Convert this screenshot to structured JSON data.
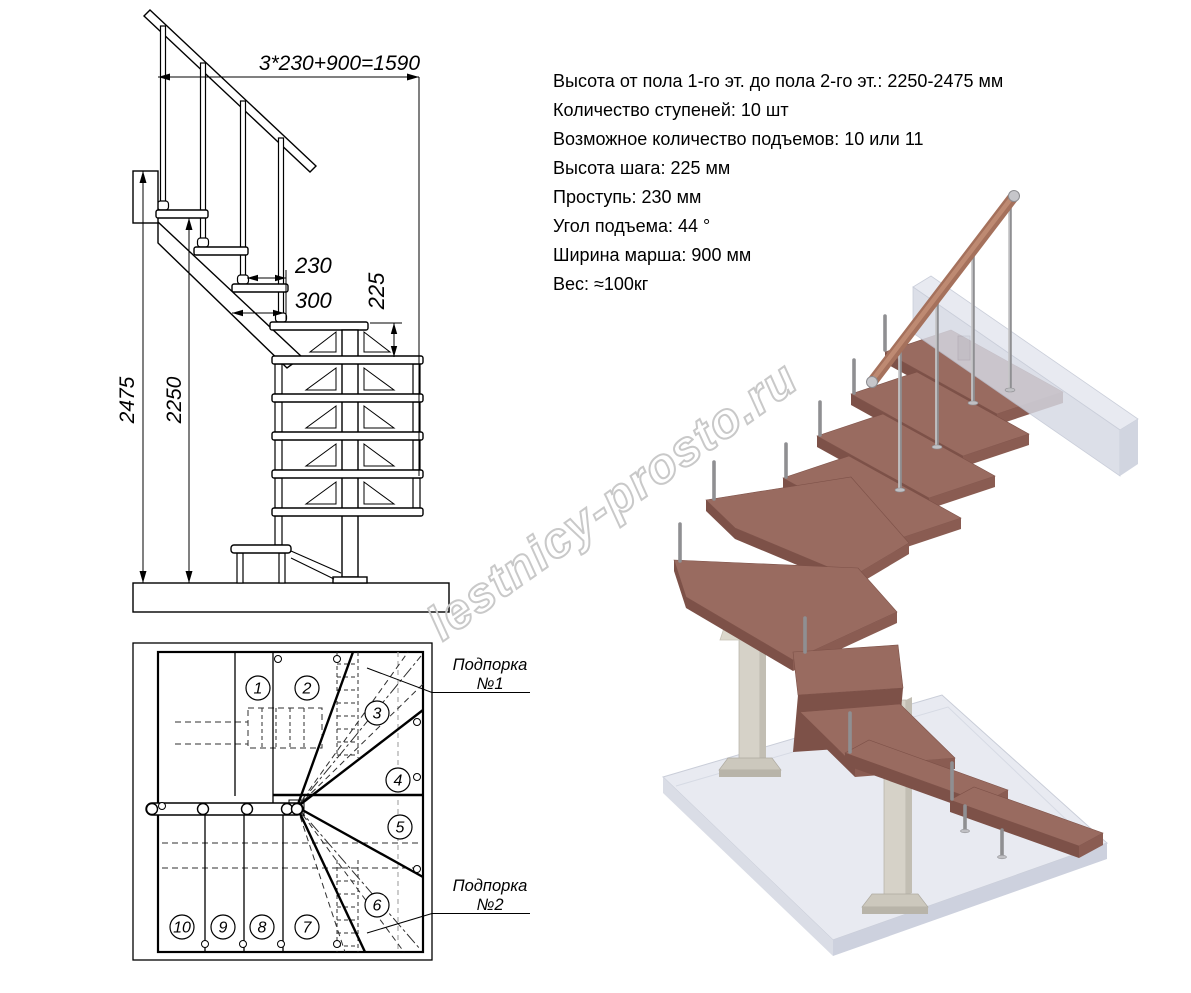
{
  "specs": {
    "lines": [
      "Высота от пола 1-го эт. до пола 2-го эт.: 2250-2475 мм",
      "Количество ступеней: 10 шт",
      "Возможное количество подъемов: 10 или 11",
      "Высота шага: 225 мм",
      "Проступь: 230 мм",
      "Угол подъема: 44 °",
      "Ширина марша: 900 мм",
      "Вес: ≈100кг"
    ]
  },
  "elevation": {
    "dim_total": "3*230+900=1590",
    "dim_run": "230",
    "dim_overlap": "300",
    "dim_rise": "225",
    "dim_height_max": "2475",
    "dim_height_min": "2250"
  },
  "plan": {
    "steps": [
      "1",
      "2",
      "3",
      "4",
      "5",
      "6",
      "7",
      "8",
      "9",
      "10"
    ],
    "support1": {
      "title": "Подпорка",
      "number": "№1"
    },
    "support2": {
      "title": "Подпорка",
      "number": "№2"
    }
  },
  "watermark": {
    "text": "lestnicy-prosto.ru"
  },
  "colors": {
    "wood_top": "#996B60",
    "wood_front": "#7D5148",
    "wood_side": "#8A5C52",
    "handrail": "#A5715C",
    "handrail_light": "#BE8A72",
    "metal": "#8F8F92",
    "metal_light": "#DCDCDE",
    "slab_top": "#E8EAF1",
    "slab_front": "#DADDE6",
    "slab_side": "#CDD1DE",
    "wall_top": "#E3E6EE",
    "wall_front": "#D5D9E4",
    "wall_side": "#C7CCDA",
    "column": "#D6D2C8",
    "column_side": "#C2BEB3",
    "plate": "#CCC8BD",
    "bracket": "#DCD8CC",
    "watermark": "#C9C9C9",
    "line": "#000000"
  }
}
